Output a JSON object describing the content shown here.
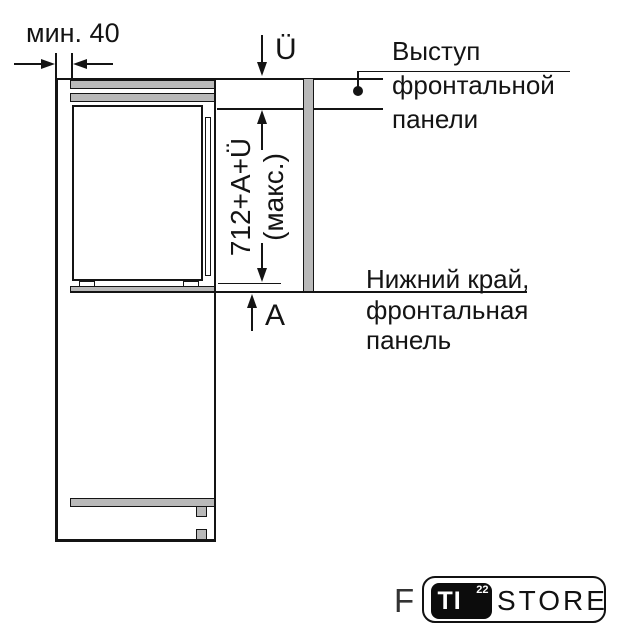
{
  "annotations": {
    "min_gap": {
      "label": "мин. 40"
    },
    "top_overhang": {
      "label": "Ü"
    },
    "max_height": {
      "line1": "712+A+Ü",
      "line2": "(макс.)"
    },
    "bottom_gap": {
      "label": "A"
    },
    "front_panel_top_note": {
      "line1": "Выступ",
      "line2": "фронтальной",
      "line3": "панели"
    },
    "front_panel_bottom_note": {
      "line1": "Нижний край,",
      "line2": "фронтальная",
      "line3": "панель"
    }
  },
  "watermark": {
    "letter": "F",
    "badge_text": "TI",
    "badge_superscript": "22",
    "brand_text": "STORE"
  },
  "colors": {
    "line": "#141414",
    "panel_fill": "#b9b9b9",
    "background": "#ffffff"
  }
}
